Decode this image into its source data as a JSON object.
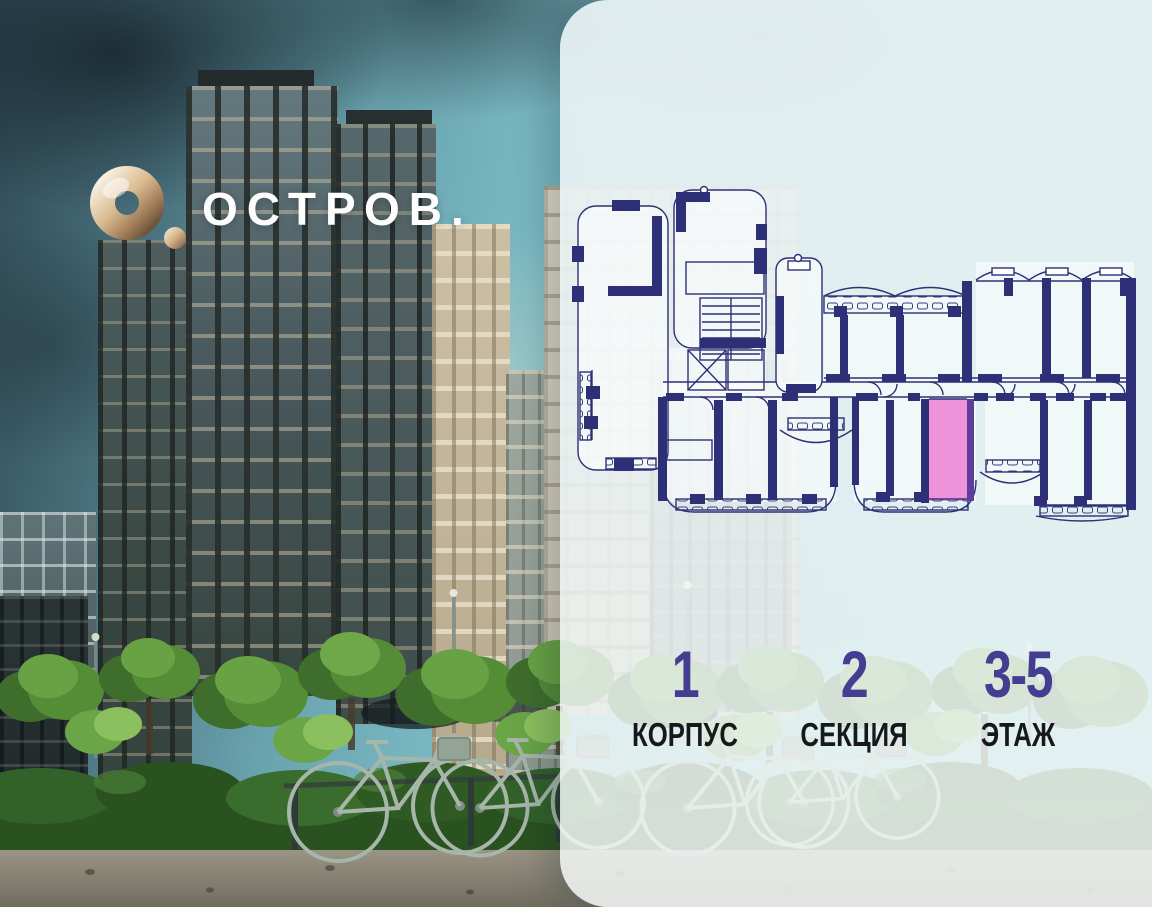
{
  "logo": {
    "text": "ОСТРОВ.",
    "mark_icon": "gold-ring-with-dot",
    "mark_color": "#c9a87e"
  },
  "floor_plan": {
    "wall_color": "#2d3076",
    "highlight_color": "#ee92da"
  },
  "stats": {
    "value_color": "#443d90",
    "items": [
      {
        "value": "1",
        "label": "КОРПУС"
      },
      {
        "value": "2",
        "label": "СЕКЦИЯ"
      },
      {
        "value": "3-5",
        "label": "ЭТАЖ"
      }
    ]
  }
}
